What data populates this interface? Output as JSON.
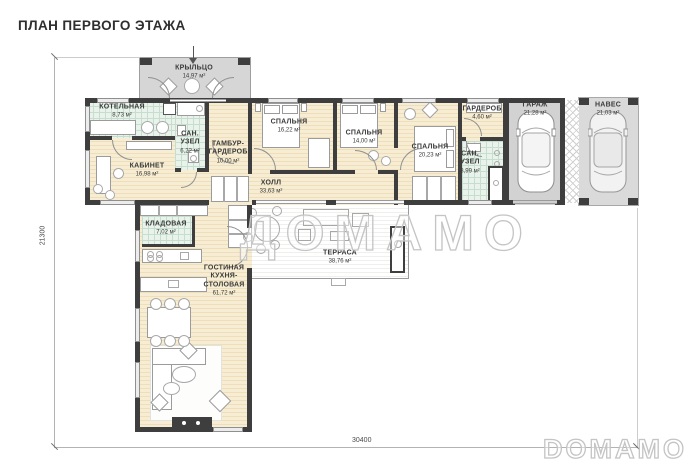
{
  "title": "ПЛАН ПЕРВОГО ЭТАЖА",
  "watermark_center": "ДОМАМО",
  "watermark_corner": "DOMAMO",
  "dimensions": {
    "height_left": "21300",
    "width_bottom": "30400"
  },
  "rooms": [
    {
      "id": "porch",
      "name": "КРЫЛЬЦО",
      "area": "14,97 м²"
    },
    {
      "id": "boiler",
      "name": "КОТЕЛЬНАЯ",
      "area": "8,73 м²"
    },
    {
      "id": "bath-1",
      "name": "САН. УЗЕЛ",
      "area": "6,22 м²"
    },
    {
      "id": "tambour",
      "name": "ТАМБУР-ГАРДЕРОБ",
      "area": "10,00 м²"
    },
    {
      "id": "study",
      "name": "КАБИНЕТ",
      "area": "16,98 м²"
    },
    {
      "id": "bedroom-1",
      "name": "СПАЛЬНЯ",
      "area": "16,22 м²"
    },
    {
      "id": "bedroom-2",
      "name": "СПАЛЬНЯ",
      "area": "14,00 м²"
    },
    {
      "id": "bedroom-3",
      "name": "СПАЛЬНЯ",
      "area": "20,23 м²"
    },
    {
      "id": "wardrobe",
      "name": "ГАРДЕРОБ",
      "area": "4,60 м²"
    },
    {
      "id": "bath-2",
      "name": "САН. УЗЕЛ",
      "area": "8,99 м²"
    },
    {
      "id": "garage",
      "name": "ГАРАЖ",
      "area": "21,28 м²"
    },
    {
      "id": "carport",
      "name": "НАВЕС",
      "area": "21,03 м²"
    },
    {
      "id": "hall",
      "name": "ХОЛЛ",
      "area": "33,63 м²"
    },
    {
      "id": "pantry",
      "name": "КЛАДОВАЯ",
      "area": "7,02 м²"
    },
    {
      "id": "living",
      "name": "ГОСТИНАЯ КУХНЯ-СТОЛОВАЯ",
      "area": "61,72 м²"
    },
    {
      "id": "terrace",
      "name": "ТЕРРАСА",
      "area": "38,76 м²"
    }
  ],
  "colors": {
    "wall": "#3e3e3e",
    "floor_wood": "#f6ebd0",
    "floor_tile": "#e9f3ec",
    "concrete": "#d6d6d6",
    "watermark": "#c4c4c4"
  }
}
